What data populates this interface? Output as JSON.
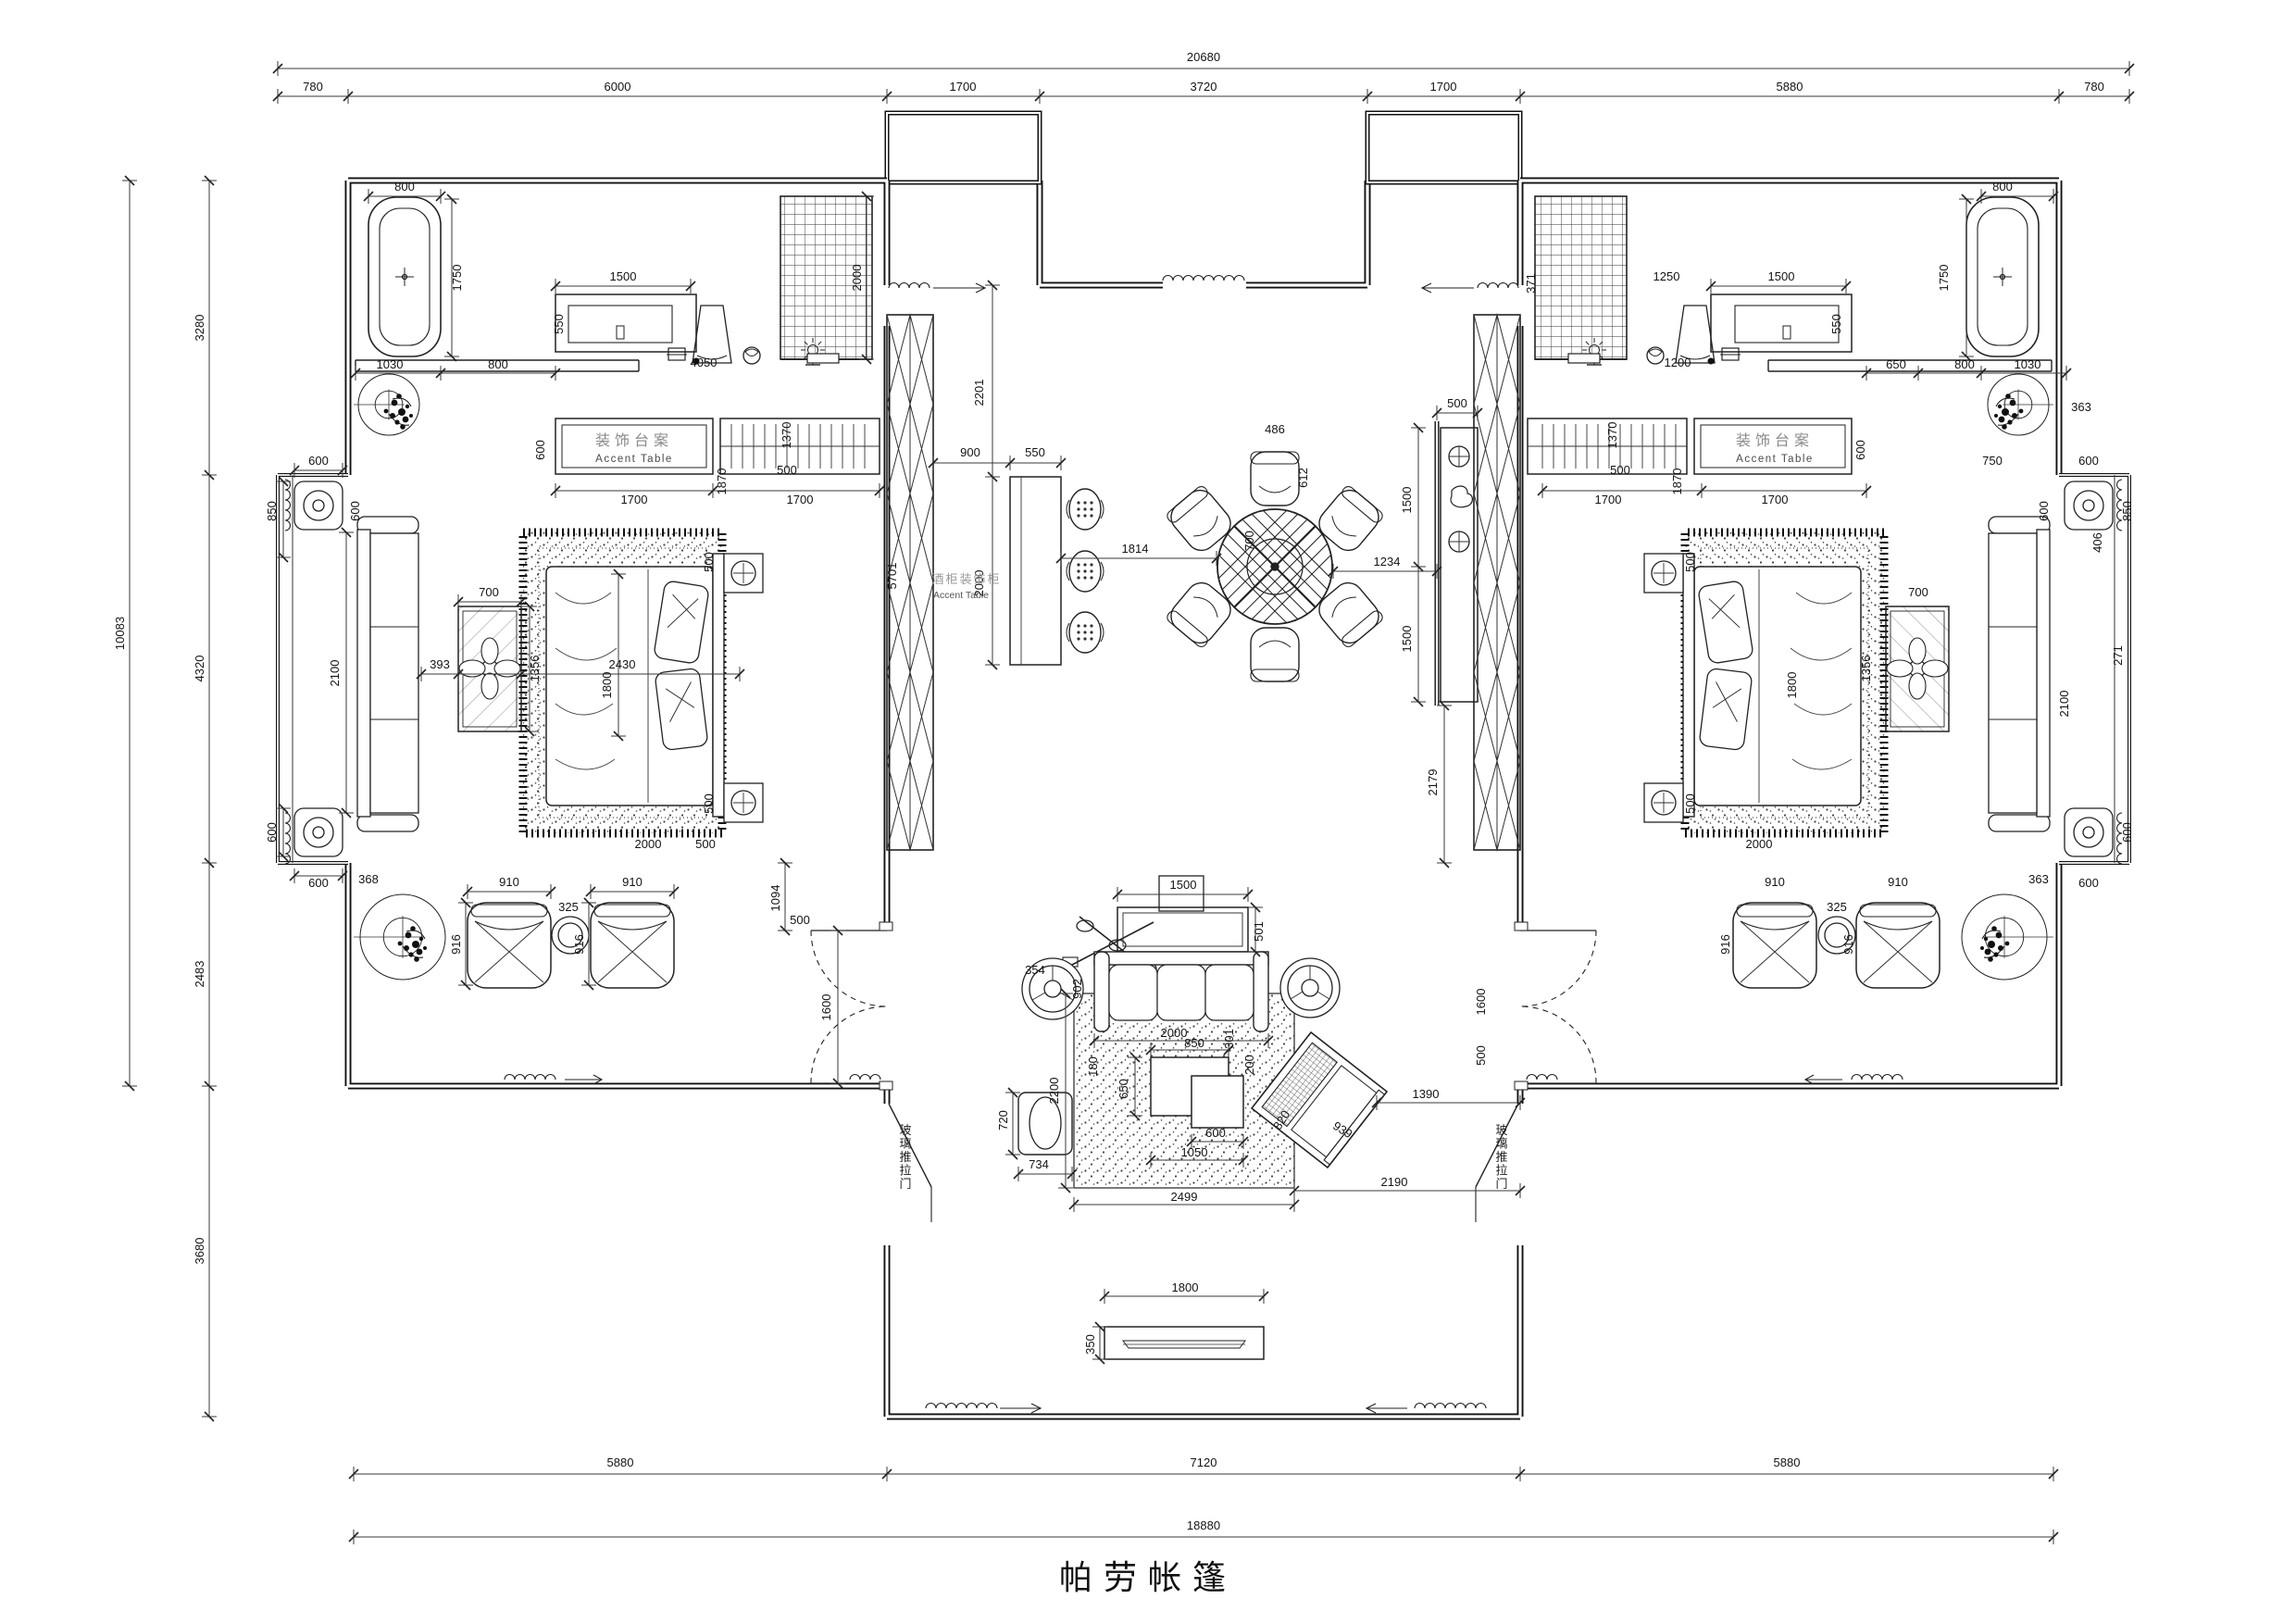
{
  "drawing": {
    "title": "帕劳帐篷",
    "labels": {
      "accent_table_zh": "装饰台案",
      "accent_table_en": "Accent Table",
      "wine_cabinet_zh": "酒柜装饰柜",
      "glass_sliding_door": "玻璃推拉门"
    },
    "overall_dimensions": {
      "top_total": "20680",
      "top_segments": [
        "780",
        "6000",
        "1700",
        "3720",
        "1700",
        "5880",
        "780"
      ],
      "left_total": "10083",
      "left_segments": [
        "3280",
        "4320",
        "2483",
        "3680"
      ],
      "bottom_segments": [
        "5880",
        "7120",
        "5880"
      ],
      "bottom_total": "18880"
    }
  },
  "annotations": [
    [
      "20680",
      1300,
      66
    ],
    [
      "780",
      338,
      98
    ],
    [
      "6000",
      667,
      98
    ],
    [
      "1700",
      1040,
      98
    ],
    [
      "3720",
      1300,
      98
    ],
    [
      "1700",
      1559,
      98
    ],
    [
      "5880",
      1933,
      98
    ],
    [
      "780",
      2262,
      98
    ],
    [
      "10083",
      134,
      684,
      -90
    ],
    [
      "3280",
      220,
      354,
      -90
    ],
    [
      "4320",
      220,
      722,
      -90
    ],
    [
      "2483",
      220,
      1052,
      -90
    ],
    [
      "3680",
      220,
      1351,
      -90
    ],
    [
      "5880",
      670,
      1584
    ],
    [
      "7120",
      1300,
      1584
    ],
    [
      "5880",
      1930,
      1584
    ],
    [
      "18880",
      1300,
      1652
    ],
    [
      "800",
      437,
      206
    ],
    [
      "1750",
      498,
      300,
      -90
    ],
    [
      "1030",
      421,
      398
    ],
    [
      "800",
      538,
      398
    ],
    [
      "1500",
      673,
      303
    ],
    [
      "550",
      608,
      350,
      -90
    ],
    [
      "4050",
      760,
      396
    ],
    [
      "2000",
      930,
      300,
      -90
    ],
    [
      "装饰台案",
      685,
      481,
      0,
      "zh"
    ],
    [
      "Accent Table",
      685,
      499,
      0,
      "en"
    ],
    [
      "600",
      588,
      486,
      -90
    ],
    [
      "1700",
      685,
      544
    ],
    [
      "1700",
      864,
      544
    ],
    [
      "2201",
      1062,
      424,
      -90
    ],
    [
      "2000",
      1062,
      630,
      -90
    ],
    [
      "900",
      1048,
      493
    ],
    [
      "550",
      1118,
      493
    ],
    [
      "5701",
      968,
      622,
      -90
    ],
    [
      "酒柜装饰柜",
      1044,
      630,
      0,
      "zhsm"
    ],
    [
      "Accent Table",
      1038,
      646,
      0,
      "ensm"
    ],
    [
      "1870",
      784,
      520,
      -90
    ],
    [
      "1370",
      854,
      470,
      -90
    ],
    [
      "500",
      850,
      512
    ],
    [
      "500",
      770,
      607,
      -90
    ],
    [
      "500",
      770,
      868,
      -90
    ],
    [
      "1800",
      660,
      740,
      -90
    ],
    [
      "2430",
      672,
      722
    ],
    [
      "393",
      475,
      722
    ],
    [
      "700",
      528,
      644
    ],
    [
      "1356",
      582,
      722,
      -90
    ],
    [
      "2000",
      700,
      916
    ],
    [
      "500",
      762,
      916
    ],
    [
      "1094",
      842,
      970,
      -90
    ],
    [
      "500",
      864,
      998
    ],
    [
      "600",
      344,
      502
    ],
    [
      "850",
      298,
      552,
      -90
    ],
    [
      "600",
      388,
      552,
      -90
    ],
    [
      "2100",
      366,
      727,
      -90
    ],
    [
      "600",
      298,
      899,
      -90
    ],
    [
      "600",
      344,
      958
    ],
    [
      "368",
      398,
      954
    ],
    [
      "910",
      550,
      957
    ],
    [
      "910",
      683,
      957
    ],
    [
      "325",
      614,
      984
    ],
    [
      "916",
      497,
      1020,
      -90
    ],
    [
      "916",
      630,
      1020,
      -90
    ],
    [
      "1600",
      897,
      1088,
      -90
    ],
    [
      "玻璃推拉门",
      978,
      1225,
      0,
      "vzh"
    ],
    [
      "玻璃推拉门",
      1622,
      1225,
      0,
      "vzh"
    ],
    [
      "486",
      1377,
      468
    ],
    [
      "612",
      1412,
      516,
      -90
    ],
    [
      "700",
      1354,
      584,
      -90
    ],
    [
      "1814",
      1226,
      597
    ],
    [
      "1234",
      1498,
      611
    ],
    [
      "1500",
      1524,
      540,
      -90
    ],
    [
      "1500",
      1524,
      690,
      -90
    ],
    [
      "500",
      1574,
      440
    ],
    [
      "2179",
      1552,
      845,
      -90
    ],
    [
      "1500",
      1278,
      960
    ],
    [
      "501",
      1364,
      1006,
      -90
    ],
    [
      "902",
      1168,
      1068,
      -90
    ],
    [
      "354",
      1118,
      1052
    ],
    [
      "2000",
      1268,
      1120
    ],
    [
      "850",
      1290,
      1131
    ],
    [
      "301",
      1332,
      1122,
      -90
    ],
    [
      "650",
      1218,
      1176,
      -90
    ],
    [
      "200",
      1354,
      1150,
      -90
    ],
    [
      "600",
      1313,
      1228
    ],
    [
      "1050",
      1290,
      1249
    ],
    [
      "180",
      1185,
      1152,
      -90
    ],
    [
      "2200",
      1143,
      1178,
      -90
    ],
    [
      "2499",
      1279,
      1297
    ],
    [
      "820",
      1388,
      1212,
      -58
    ],
    [
      "939",
      1448,
      1224,
      32
    ],
    [
      "734",
      1122,
      1262
    ],
    [
      "720",
      1088,
      1210,
      -90
    ],
    [
      "1390",
      1540,
      1186
    ],
    [
      "2190",
      1506,
      1281
    ],
    [
      "1600",
      1604,
      1082,
      -90
    ],
    [
      "500",
      1604,
      1140,
      -90
    ],
    [
      "1800",
      1280,
      1395
    ],
    [
      "350",
      1182,
      1452,
      -90
    ],
    [
      "371",
      1658,
      306,
      -90
    ],
    [
      "1200",
      1812,
      396
    ],
    [
      "1250",
      1800,
      303
    ],
    [
      "1500",
      1924,
      303
    ],
    [
      "550",
      1988,
      350,
      -90
    ],
    [
      "650",
      2048,
      398
    ],
    [
      "800",
      2122,
      398
    ],
    [
      "1030",
      2190,
      398
    ],
    [
      "800",
      2163,
      206
    ],
    [
      "1750",
      2104,
      300,
      -90
    ],
    [
      "363",
      2248,
      444
    ],
    [
      "装饰台案",
      1917,
      481,
      0,
      "zh"
    ],
    [
      "Accent Table",
      1917,
      499,
      0,
      "en"
    ],
    [
      "1700",
      1737,
      544
    ],
    [
      "1700",
      1917,
      544
    ],
    [
      "600",
      2014,
      486,
      -90
    ],
    [
      "1870",
      1816,
      520,
      -90
    ],
    [
      "1370",
      1746,
      470,
      -90
    ],
    [
      "500",
      1750,
      512
    ],
    [
      "500",
      1830,
      607,
      -90
    ],
    [
      "500",
      1830,
      868,
      -90
    ],
    [
      "1800",
      1940,
      740,
      -90
    ],
    [
      "2000",
      1900,
      916
    ],
    [
      "700",
      2072,
      644
    ],
    [
      "1356",
      2020,
      722,
      -90
    ],
    [
      "750",
      2152,
      502
    ],
    [
      "600",
      2256,
      502
    ],
    [
      "406",
      2270,
      586,
      -90
    ],
    [
      "2100",
      2234,
      760,
      -90
    ],
    [
      "850",
      2302,
      552,
      -90
    ],
    [
      "600",
      2212,
      552,
      -90
    ],
    [
      "600",
      2302,
      899,
      -90
    ],
    [
      "600",
      2256,
      958
    ],
    [
      "271",
      2292,
      708,
      -90
    ],
    [
      "363",
      2202,
      954
    ],
    [
      "910",
      1917,
      957
    ],
    [
      "910",
      2050,
      957
    ],
    [
      "325",
      1984,
      984
    ],
    [
      "916",
      1868,
      1020,
      -90
    ],
    [
      "916",
      2001,
      1020,
      -90
    ]
  ]
}
